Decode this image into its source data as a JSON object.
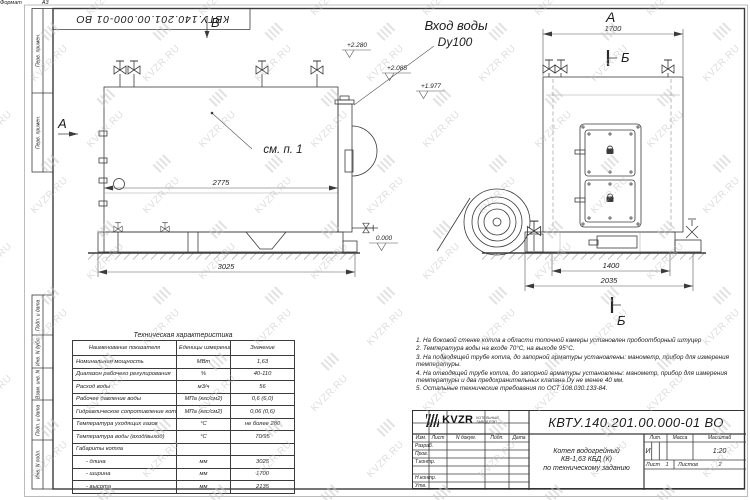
{
  "sheet": {
    "designation_top": "КВТУ.140.201.00.000-01 ВО",
    "format_label": "Формат",
    "format_value": "А3",
    "frame_labels": [
      "Перв. примен.",
      "Перв. примен.",
      "Подп. и дата",
      "Инв. N дубл.",
      "Взам. инв. N",
      "Подп. и дата",
      "Инв. N подл."
    ]
  },
  "watermark": {
    "text": "KVZR.RU"
  },
  "views": {
    "side": {
      "view_label_top": "В",
      "view_label_left": "А",
      "inlet_label_line1": "Вход воды",
      "inlet_label_line2": "Dy100",
      "see_note": "см. п. 1",
      "dim_body": "2775",
      "dim_overall": "3025",
      "elev_top": "+2.280",
      "elev_flange": "+2.085",
      "elev_third": "+1.977",
      "elev_zero": "0.000"
    },
    "front": {
      "title": "А",
      "dim_top": "1700",
      "section_label_top": "Б",
      "section_label_bottom": "Б",
      "dim_base_inner": "1400",
      "dim_base_outer": "2035"
    }
  },
  "spec_table": {
    "title": "Техническая характеристика",
    "headers": [
      "Наименование показателя",
      "Еденицы измерения",
      "Значение"
    ],
    "rows": [
      [
        "Номинальная мощность",
        "МВт",
        "1,63"
      ],
      [
        "Диапазон рабочего регулирования",
        "%",
        "40-110"
      ],
      [
        "Расход воды",
        "м3/ч",
        "56"
      ],
      [
        "Рабочее давление воды",
        "МПа (кгс/см2)",
        "0,6 (6,0)"
      ],
      [
        "Гидравлическое сопротивление котла",
        "МПа (кгс/см2)",
        "0,06 (0,6)"
      ],
      [
        "Температура уходящих газов",
        "°С",
        "не более 280"
      ],
      [
        "Температура воды (вход/выход)",
        "°С",
        "70/95"
      ],
      [
        "Габариты котла",
        "",
        ""
      ],
      [
        "- длина",
        "мм",
        "3025"
      ],
      [
        "- ширина",
        "мм",
        "1700"
      ],
      [
        "- высота",
        "мм",
        "2135"
      ]
    ]
  },
  "notes": {
    "items": [
      "1. На боковой стенке котла в области топочной камеры установлен пробоотборный штуцер",
      "2. Температура воды на входе 70°С, на выходе 95°С.",
      "3. На подводящей трубе котла, до запорной арматуры установлены: манометр, прибор для измерения температуры.",
      "4. На отводящей трубе котла, до запорной арматуры установлены: манометр, прибор для измерения температуры и два предохранительных клапана Dу не менее 40 мм.",
      "5. Остальные технические требования по ОСТ 108.030.133-84."
    ]
  },
  "title_block": {
    "designation": "КВТУ.140.201.00.000-01 ВО",
    "rev_headers": [
      "Изм.",
      "Лист",
      "N докум.",
      "Подп.",
      "Дата"
    ],
    "row_labels": [
      "Разраб.",
      "Пров.",
      "Т.контр.",
      "",
      "Н.контр.",
      "Утв."
    ],
    "doc_name_lines": [
      "Котел водогрейный",
      "КВ-1,63 КБД (К)",
      "по техническому заданию"
    ],
    "lit_header": "Лит.",
    "mass_header": "Масса",
    "scale_header": "Масштаб",
    "lit_value": "И",
    "scale_value": "1:20",
    "sheet_label": "Лист",
    "sheet_value": "1",
    "sheets_label": "Листов",
    "sheets_value": "2",
    "company_logo": "KVZR",
    "company_name_line1": "КОТЕЛЬНЫЙ",
    "company_name_line2": "ЗАВОД РЭП"
  }
}
